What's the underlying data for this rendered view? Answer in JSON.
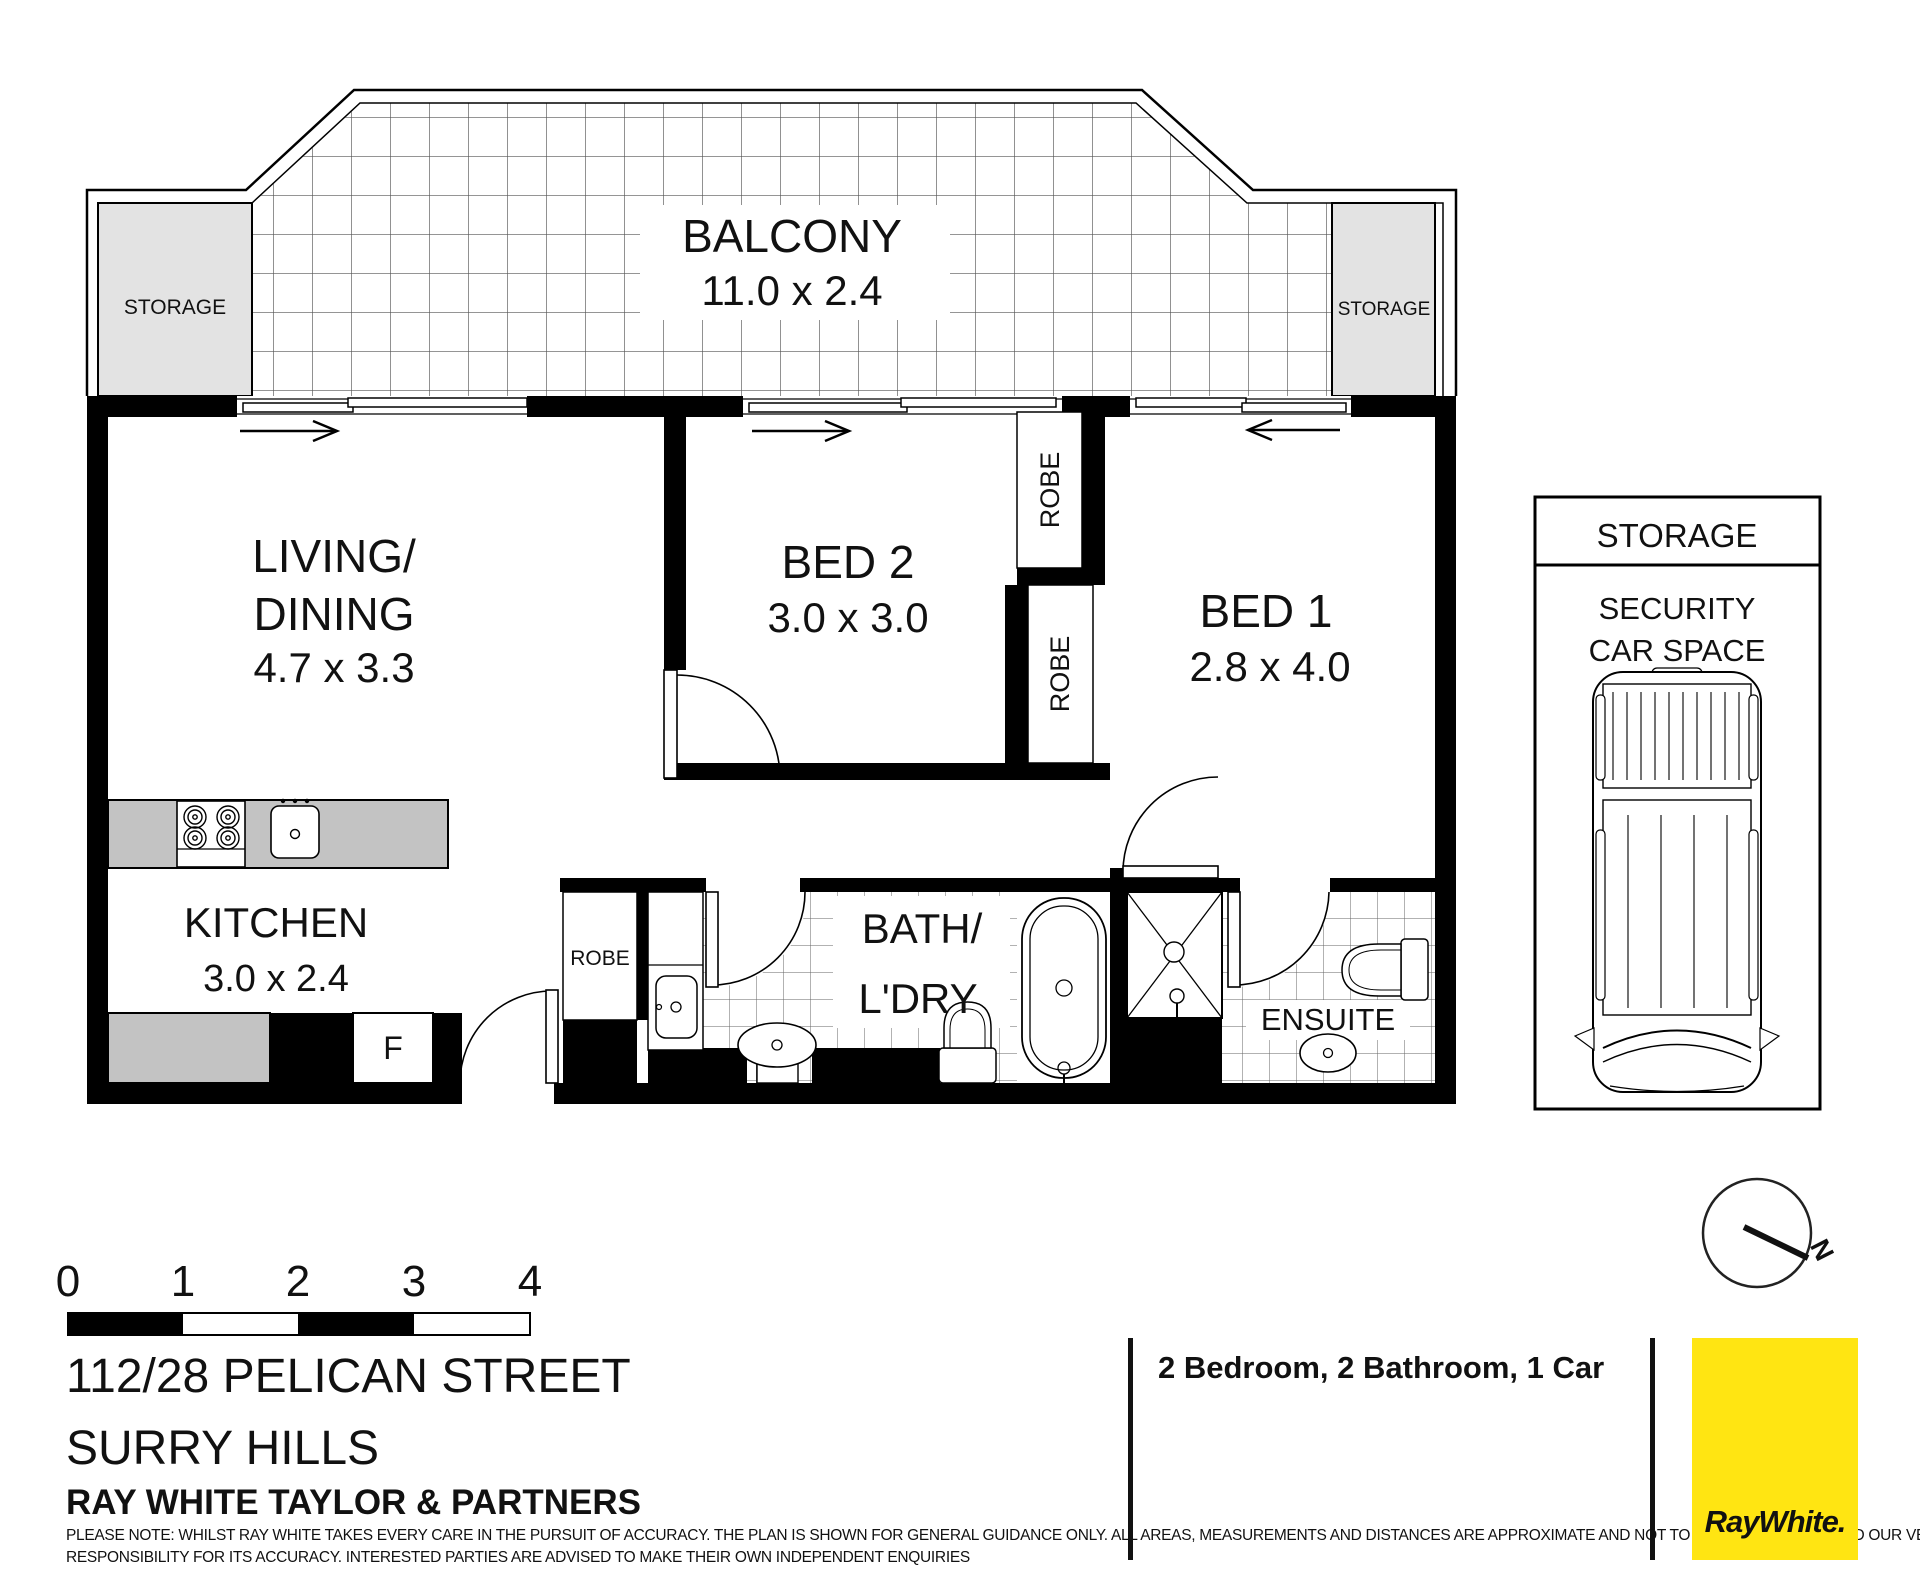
{
  "plan": {
    "balcony": {
      "name": "BALCONY",
      "dims": "11.0 x 2.4"
    },
    "storage_left": "STORAGE",
    "storage_right": "STORAGE",
    "living": {
      "name1": "LIVING/",
      "name2": "DINING",
      "dims": "4.7 x 3.3"
    },
    "bed2": {
      "name": "BED 2",
      "dims": "3.0 x 3.0"
    },
    "bed1": {
      "name": "BED 1",
      "dims": "2.8 x 4.0"
    },
    "kitchen": {
      "name": "KITCHEN",
      "dims": "3.0 x 2.4"
    },
    "bath": {
      "name1": "BATH/",
      "name2": "L'DRY"
    },
    "ensuite": "ENSUITE",
    "robe_bed2": "ROBE",
    "robe_bed1": "ROBE",
    "robe_hall": "ROBE",
    "fridge": "F"
  },
  "car_space": {
    "header": "STORAGE",
    "line1": "SECURITY",
    "line2": "CAR SPACE"
  },
  "compass": {
    "north": "N"
  },
  "scale_bar": {
    "labels": [
      "0",
      "1",
      "2",
      "3",
      "4"
    ]
  },
  "address": {
    "line1": "112/28 PELICAN STREET",
    "line2": "SURRY HILLS",
    "agency": "RAY WHITE TAYLOR & PARTNERS"
  },
  "summary": "2 Bedroom, 2 Bathroom, 1 Car",
  "logo": {
    "wordmark": "RayWhite."
  },
  "disclaimer": {
    "line1": "PLEASE NOTE: WHILST RAY WHITE TAKES EVERY CARE IN THE PURSUIT OF ACCURACY. THE PLAN IS SHOWN FOR GENERAL GUIDANCE ONLY. ALL AREAS, MEASUREMENTS AND DISTANCES ARE APPROXIMATE AND NOT TO SCALE RAY WHITE AND OUR VENDOR WILL ACCEPT NO",
    "line2": "RESPONSIBILITY FOR ITS ACCURACY. INTERESTED PARTIES ARE ADVISED TO MAKE THEIR OWN INDEPENDENT ENQUIRIES"
  },
  "colors": {
    "wall": "#000000",
    "storage_fill": "#e3e3e3",
    "counter_fill": "#c3c3c3",
    "tile_line": "#555555",
    "logo_yellow": "#FFE512",
    "logo_text": "#58595B"
  }
}
